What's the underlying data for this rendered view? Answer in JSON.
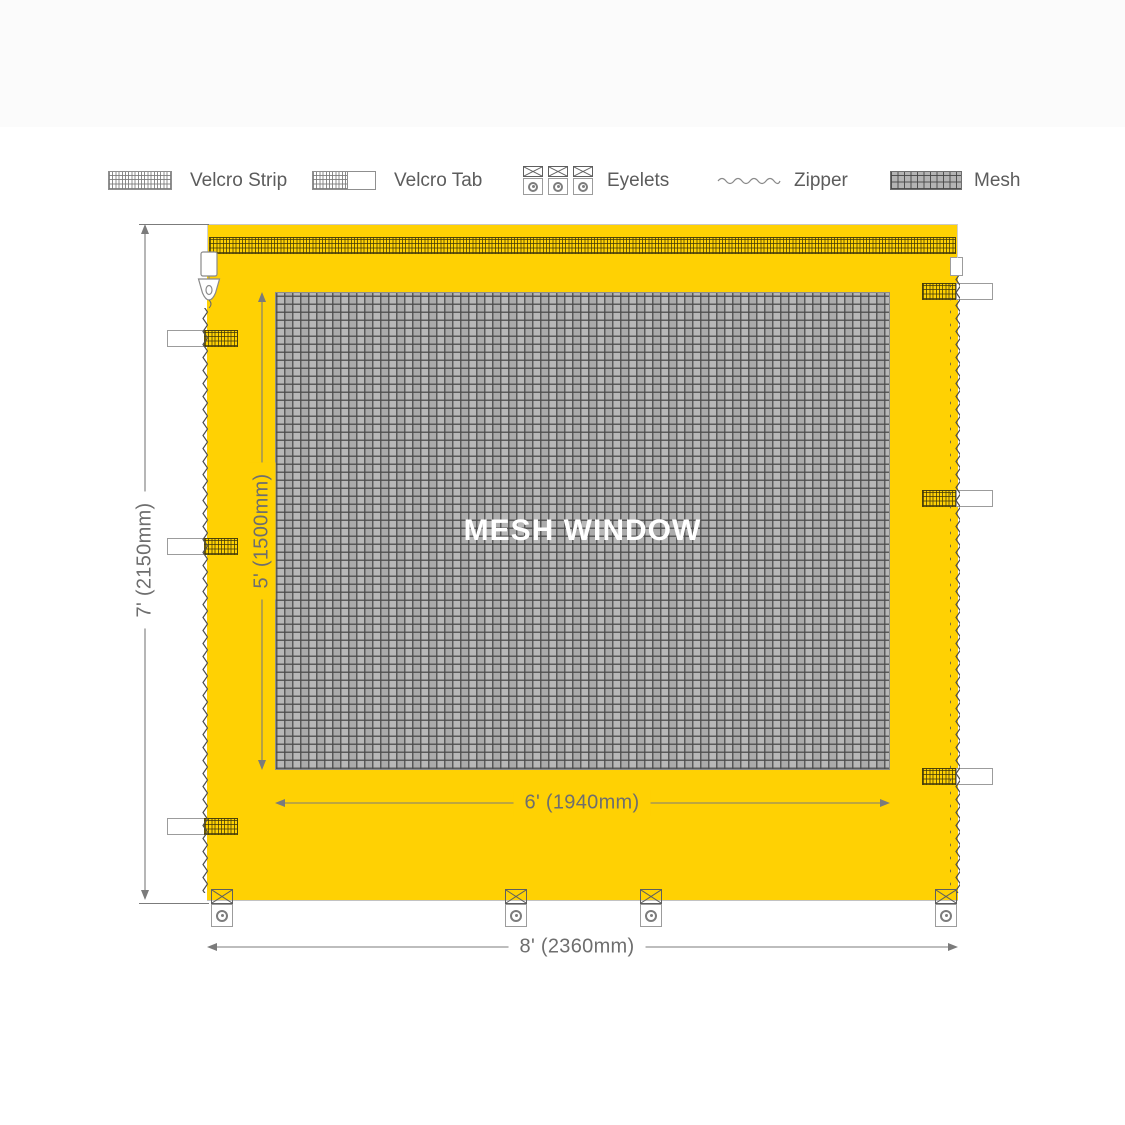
{
  "legend": {
    "velcro_strip": "Velcro Strip",
    "velcro_tab": "Velcro Tab",
    "eyelets": "Eyelets",
    "zipper": "Zipper",
    "mesh": "Mesh"
  },
  "diagram": {
    "window_label": "MESH WINDOW",
    "dimensions": {
      "panel_height": "7' (2150mm)",
      "window_height": "5' (1500mm)",
      "window_width": "6' (1940mm)",
      "panel_width": "8' (2360mm)"
    }
  },
  "colors": {
    "fabric": "#FFD103",
    "mesh-base": "#B4B4B4",
    "mesh-line": "#6F6F6F",
    "dim-line": "#7B7B7B",
    "text-gray": "#5C5C5C"
  }
}
